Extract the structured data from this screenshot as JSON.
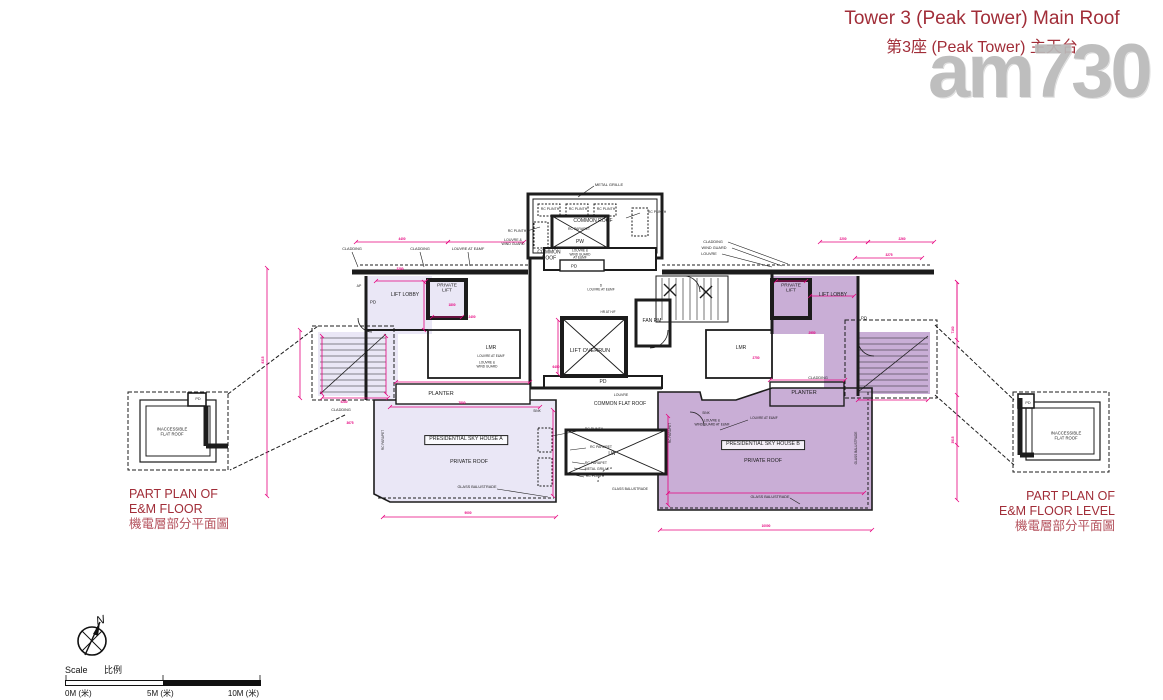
{
  "title": {
    "line1": "Tower 3 (Peak Tower) Main Roof",
    "line2": "第3座 (Peak Tower) 主天台"
  },
  "watermark": "am730",
  "part_plan_left": {
    "en1": "PART PLAN OF",
    "en2": "E&M FLOOR",
    "zh": "機電層部分平面圖"
  },
  "part_plan_right": {
    "en1": "PART PLAN OF",
    "en2": "E&M FLOOR LEVEL",
    "zh": "機電層部分平面圖"
  },
  "scale_bar": {
    "label_en": "Scale",
    "label_zh": "比例",
    "t0": "0M (米)",
    "t5": "5M (米)",
    "t10": "10M (米)"
  },
  "compass": {
    "north_label": "N"
  },
  "colors": {
    "dimension_pink": "#e6007e",
    "plan_line": "#1c1c1c",
    "house_a_fill": "#eae7f6",
    "house_b_fill": "#c9aed6",
    "title_red": "#a12d38",
    "watermark_gray": "#b9b9b9"
  },
  "plan_labels": [
    {
      "t": "METAL GRILLE",
      "x": 609,
      "y": 185,
      "fs": 4
    },
    {
      "t": "RC PLINTH",
      "x": 550,
      "y": 210,
      "fs": 3.5
    },
    {
      "t": "RC PLINTH",
      "x": 578,
      "y": 210,
      "fs": 3.5
    },
    {
      "t": "RC PLINTH",
      "x": 606,
      "y": 210,
      "fs": 3.5
    },
    {
      "t": "COMMON ROOF",
      "x": 593,
      "y": 222,
      "fs": 5
    },
    {
      "t": "RC PARAPET",
      "x": 579,
      "y": 230,
      "fs": 3.5
    },
    {
      "t": "PW",
      "x": 580,
      "y": 243,
      "fs": 5
    },
    {
      "t": "RC PLINTH",
      "x": 657,
      "y": 213,
      "fs": 3.5
    },
    {
      "t": "RC PLINTH",
      "x": 517,
      "y": 232,
      "fs": 3.5
    },
    {
      "t": "LOUVRE &\nWIND GUARD",
      "x": 513,
      "y": 243,
      "fs": 3.5
    },
    {
      "t": "COMMON\nROOF",
      "x": 549,
      "y": 256,
      "fs": 5
    },
    {
      "t": "LOUVRE &\nWIND GUARD\nAT E&MF",
      "x": 580,
      "y": 255,
      "fs": 3.2
    },
    {
      "t": "PD",
      "x": 574,
      "y": 266,
      "fs": 4.5
    },
    {
      "t": "CLADDING",
      "x": 352,
      "y": 249,
      "fs": 3.8
    },
    {
      "t": "CLADDING",
      "x": 420,
      "y": 249,
      "fs": 3.8
    },
    {
      "t": "LOUVRE AT E&MF",
      "x": 468,
      "y": 249,
      "fs": 3.8
    },
    {
      "t": "CLADDING",
      "x": 713,
      "y": 242,
      "fs": 3.8
    },
    {
      "t": "WIND GUARD",
      "x": 714,
      "y": 248,
      "fs": 3.8
    },
    {
      "t": "LOUVRE",
      "x": 709,
      "y": 254,
      "fs": 3.8
    },
    {
      "t": "AP",
      "x": 359,
      "y": 287,
      "fs": 3.5
    },
    {
      "t": "PD",
      "x": 373,
      "y": 302,
      "fs": 4.5
    },
    {
      "t": "LIFT LOBBY",
      "x": 405,
      "y": 296,
      "fs": 5
    },
    {
      "t": "PRIVATE\nLIFT",
      "x": 447,
      "y": 289,
      "fs": 4.8
    },
    {
      "t": "LMR",
      "x": 491,
      "y": 349,
      "fs": 5
    },
    {
      "t": "LOUVRE AT E&MF",
      "x": 491,
      "y": 357,
      "fs": 3.2
    },
    {
      "t": "LOUVRE &\nWIND GUARD",
      "x": 487,
      "y": 365,
      "fs": 3.2
    },
    {
      "t": "PLANTER",
      "x": 441,
      "y": 394,
      "fs": 5.5
    },
    {
      "t": "CLADDING",
      "x": 341,
      "y": 410,
      "fs": 3.8
    },
    {
      "t": "SINK",
      "x": 537,
      "y": 412,
      "fs": 3.2
    },
    {
      "t": "D\nLOUVRE AT E&MF",
      "x": 601,
      "y": 288,
      "fs": 3.2
    },
    {
      "t": "HR AT H/F",
      "x": 608,
      "y": 313,
      "fs": 3.2
    },
    {
      "t": "FAN RM",
      "x": 652,
      "y": 322,
      "fs": 5
    },
    {
      "t": "LIFT OVERRUN",
      "x": 590,
      "y": 351,
      "fs": 5.5
    },
    {
      "t": "PD",
      "x": 603,
      "y": 383,
      "fs": 5
    },
    {
      "t": "LOUVRE",
      "x": 621,
      "y": 396,
      "fs": 3.5
    },
    {
      "t": "COMMON FLAT ROOF",
      "x": 620,
      "y": 405,
      "fs": 5
    },
    {
      "t": "LW",
      "x": 612,
      "y": 455,
      "fs": 5
    },
    {
      "t": "RC PLINTH",
      "x": 594,
      "y": 430,
      "fs": 3.5
    },
    {
      "t": "RC PARAPET",
      "x": 601,
      "y": 448,
      "fs": 3.5
    },
    {
      "t": "RC PARAPET",
      "x": 596,
      "y": 464,
      "fs": 3.5
    },
    {
      "t": "METAL GRILLE",
      "x": 597,
      "y": 470,
      "fs": 3.5
    },
    {
      "t": "RC PLINTH",
      "x": 595,
      "y": 477,
      "fs": 3.5
    },
    {
      "t": "GLASS BALUSTRADE",
      "x": 630,
      "y": 490,
      "fs": 3.5
    },
    {
      "t": "PRESIDENTIAL SKY HOUSE A",
      "x": 466,
      "y": 440,
      "fs": 5.2,
      "box": true
    },
    {
      "t": "PRIVATE ROOF",
      "x": 469,
      "y": 463,
      "fs": 5.2
    },
    {
      "t": "GLASS BALUSTRADE",
      "x": 477,
      "y": 487,
      "fs": 3.8
    },
    {
      "t": "RC PARAPET",
      "x": 384,
      "y": 440,
      "fs": 3.2,
      "rot": -90
    },
    {
      "t": "PRESIDENTIAL SKY HOUSE B",
      "x": 763,
      "y": 445,
      "fs": 5.2,
      "box": true
    },
    {
      "t": "PRIVATE ROOF",
      "x": 763,
      "y": 462,
      "fs": 5.2
    },
    {
      "t": "GLASS BALUSTRADE",
      "x": 770,
      "y": 497,
      "fs": 3.8
    },
    {
      "t": "GLASS BALUSTRADE",
      "x": 857,
      "y": 448,
      "fs": 3.2,
      "rot": -90
    },
    {
      "t": "RC PARAPET",
      "x": 671,
      "y": 433,
      "fs": 3.2,
      "rot": -90
    },
    {
      "t": "SINK",
      "x": 706,
      "y": 414,
      "fs": 3.2
    },
    {
      "t": "LOUVRE &\nWIND GUARD AT E&MF",
      "x": 712,
      "y": 423,
      "fs": 3.2
    },
    {
      "t": "LOUVRE AT E&MF",
      "x": 764,
      "y": 419,
      "fs": 3.2
    },
    {
      "t": "PLANTER",
      "x": 804,
      "y": 393,
      "fs": 5.5
    },
    {
      "t": "CLADDING",
      "x": 818,
      "y": 378,
      "fs": 3.8
    },
    {
      "t": "PRIVATE\nLIFT",
      "x": 791,
      "y": 289,
      "fs": 4.8
    },
    {
      "t": "LIFT LOBBY",
      "x": 833,
      "y": 296,
      "fs": 5
    },
    {
      "t": "PD",
      "x": 864,
      "y": 318,
      "fs": 4.5
    },
    {
      "t": "LMR",
      "x": 741,
      "y": 349,
      "fs": 5
    },
    {
      "t": "INACCESSIBLE\nFLAT ROOF",
      "x": 172,
      "y": 432,
      "fs": 4.2
    },
    {
      "t": "PD",
      "x": 198,
      "y": 399,
      "fs": 3.8
    },
    {
      "t": "INACCESSIBLE\nFLAT ROOF",
      "x": 1066,
      "y": 436,
      "fs": 4.2
    },
    {
      "t": "PD",
      "x": 1028,
      "y": 403,
      "fs": 3.8
    }
  ],
  "dimensions": [
    {
      "t": "4400",
      "x": 402,
      "y": 240
    },
    {
      "t": "2280",
      "x": 400,
      "y": 270
    },
    {
      "t": "1800",
      "x": 452,
      "y": 306
    },
    {
      "t": "2400",
      "x": 472,
      "y": 318
    },
    {
      "t": "2200",
      "x": 843,
      "y": 240
    },
    {
      "t": "2260",
      "x": 902,
      "y": 240
    },
    {
      "t": "3275",
      "x": 889,
      "y": 256
    },
    {
      "t": "7800",
      "x": 462,
      "y": 404
    },
    {
      "t": "6400",
      "x": 556,
      "y": 368
    },
    {
      "t": "9000",
      "x": 468,
      "y": 514
    },
    {
      "t": "10000",
      "x": 766,
      "y": 527
    },
    {
      "t": "3675",
      "x": 350,
      "y": 424
    },
    {
      "t": "5280",
      "x": 344,
      "y": 403
    },
    {
      "t": "2750",
      "x": 756,
      "y": 359
    },
    {
      "t": "2950",
      "x": 812,
      "y": 334
    },
    {
      "t": "7160",
      "x": 954,
      "y": 330,
      "rot": -90
    },
    {
      "t": "3915",
      "x": 954,
      "y": 440,
      "rot": -90
    },
    {
      "t": "8315",
      "x": 264,
      "y": 360,
      "rot": -90
    }
  ]
}
